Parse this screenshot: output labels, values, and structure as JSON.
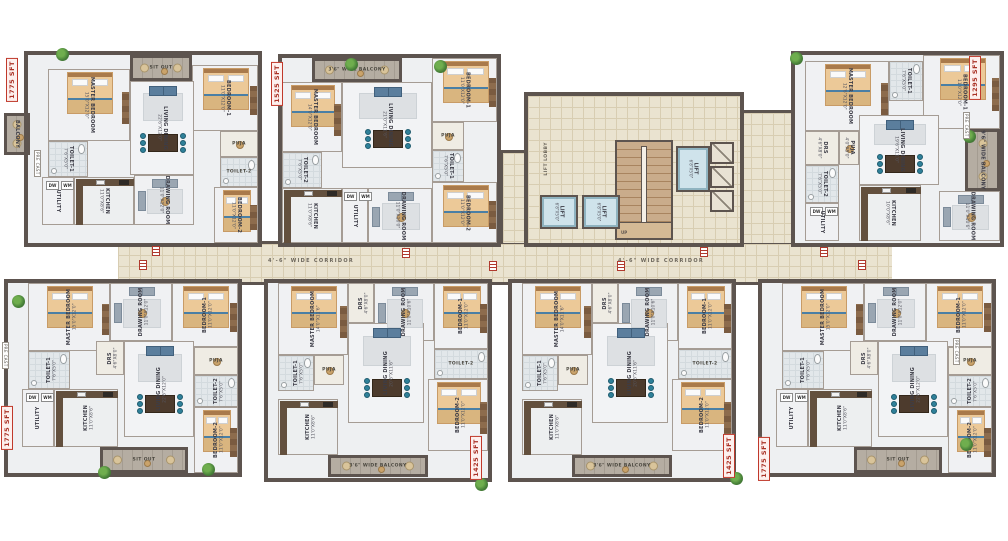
{
  "corridor": {
    "label": "4'-6\" WIDE CORRIDOR"
  },
  "core": {
    "lift_label": "LIFT",
    "lift_dim": "6'8\"X5'0\"",
    "lobby_label": "LIFT LOBBY",
    "stair_label": "UP"
  },
  "labels": {
    "precast": "PRE CAST",
    "appliances": [
      "DW",
      "WM"
    ]
  },
  "units": [
    {
      "id": "unit-t1",
      "size_label": "1775 SFT",
      "x": 28,
      "y": 55,
      "w": 230,
      "h": 188,
      "flip": true,
      "badge": [
        6,
        58
      ],
      "rooms": [
        {
          "name": "MASTER BEDROOM",
          "dim": "15'0\"X12'0\"",
          "type": "bedroom",
          "x": 20,
          "y": 14,
          "w": 82,
          "h": 72
        },
        {
          "name": "SIT OUT",
          "dim": "",
          "type": "balcony",
          "x": 102,
          "y": 0,
          "w": 62,
          "h": 26
        },
        {
          "name": "BEDROOM-1",
          "dim": "11'0\"X12'0\"",
          "type": "bedroom",
          "x": 164,
          "y": 10,
          "w": 66,
          "h": 66
        },
        {
          "name": "BALCONY",
          "dim": "",
          "type": "balcony",
          "x": -24,
          "y": 58,
          "w": 26,
          "h": 42
        },
        {
          "name": "TOILET-1",
          "dim": "7'6\"X5'0\"",
          "type": "toilet",
          "x": 20,
          "y": 86,
          "w": 40,
          "h": 36
        },
        {
          "name": "LIVING DINING",
          "dim": "22'6\"X12'0\"",
          "type": "living",
          "x": 102,
          "y": 26,
          "w": 64,
          "h": 94
        },
        {
          "name": "PUJA",
          "dim": "4'0\"X5'0\"",
          "type": "plain",
          "x": 192,
          "y": 76,
          "w": 38,
          "h": 26
        },
        {
          "name": "TOILET-2",
          "dim": "7'6\"X5'0\"",
          "type": "toilet",
          "x": 192,
          "y": 102,
          "w": 38,
          "h": 30
        },
        {
          "name": "KITCHEN",
          "dim": "11'0\"X8'6\"",
          "type": "kitchen",
          "x": 46,
          "y": 122,
          "w": 60,
          "h": 48
        },
        {
          "name": "UTILITY",
          "dim": "",
          "type": "utility",
          "x": 14,
          "y": 122,
          "w": 32,
          "h": 48
        },
        {
          "name": "DRAWING ROOM",
          "dim": "11'0\"X12'0\"",
          "type": "lounge",
          "x": 106,
          "y": 120,
          "w": 60,
          "h": 50
        },
        {
          "name": "BEDROOM-2",
          "dim": "11'0\"X12'0\"",
          "type": "bedroom",
          "x": 186,
          "y": 132,
          "w": 44,
          "h": 56
        }
      ]
    },
    {
      "id": "unit-t2",
      "size_label": "1525 SFT",
      "x": 282,
      "y": 58,
      "w": 215,
      "h": 185,
      "flip": true,
      "badge": [
        271,
        62
      ],
      "rooms": [
        {
          "name": "3'6\" WIDE BALCONY",
          "dim": "",
          "type": "balcony",
          "x": 30,
          "y": 0,
          "w": 90,
          "h": 24
        },
        {
          "name": "BEDROOM-1",
          "dim": "11'0\"X12'0\"",
          "type": "bedroom",
          "x": 150,
          "y": 0,
          "w": 65,
          "h": 64
        },
        {
          "name": "MASTER BEDROOM",
          "dim": "14'0\"X12'0\"",
          "type": "bedroom",
          "x": 0,
          "y": 24,
          "w": 60,
          "h": 70
        },
        {
          "name": "LIVING DINING",
          "dim": "21'0\"X11'6\"",
          "type": "living",
          "x": 60,
          "y": 24,
          "w": 90,
          "h": 86
        },
        {
          "name": "PUJA",
          "dim": "4'0\"X5'0\"",
          "type": "plain",
          "x": 150,
          "y": 64,
          "w": 32,
          "h": 28
        },
        {
          "name": "TOILET-1",
          "dim": "7'6\"X5'0\"",
          "type": "toilet",
          "x": 150,
          "y": 92,
          "w": 32,
          "h": 32
        },
        {
          "name": "TOILET-2",
          "dim": "7'6\"X5'0\"",
          "type": "toilet",
          "x": 0,
          "y": 94,
          "w": 40,
          "h": 36
        },
        {
          "name": "KITCHEN",
          "dim": "11'0\"X8'6\"",
          "type": "kitchen",
          "x": 0,
          "y": 130,
          "w": 60,
          "h": 55
        },
        {
          "name": "UTILITY",
          "dim": "",
          "type": "utility",
          "x": 60,
          "y": 130,
          "w": 26,
          "h": 55
        },
        {
          "name": "DRAWING ROOM",
          "dim": "11'0\"X10'0\"",
          "type": "lounge",
          "x": 86,
          "y": 130,
          "w": 64,
          "h": 55
        },
        {
          "name": "BEDROOM-2",
          "dim": "11'0\"X12'0\"",
          "type": "bedroom",
          "x": 150,
          "y": 124,
          "w": 65,
          "h": 61
        }
      ]
    },
    {
      "id": "unit-t3",
      "size_label": "1295 SFT",
      "x": 795,
      "y": 55,
      "w": 205,
      "h": 188,
      "flip": true,
      "badge": [
        969,
        56
      ],
      "rooms": [
        {
          "name": "MASTER BEDROOM",
          "dim": "12'6\"X12'0\"",
          "type": "bedroom",
          "x": 10,
          "y": 6,
          "w": 84,
          "h": 70
        },
        {
          "name": "TOILET-1",
          "dim": "7'6\"X5'0\"",
          "type": "toilet",
          "x": 94,
          "y": 6,
          "w": 34,
          "h": 40
        },
        {
          "name": "BEDROOM-1",
          "dim": "11'0\"X12'0\"",
          "type": "bedroom",
          "x": 128,
          "y": 0,
          "w": 77,
          "h": 74
        },
        {
          "name": "DRS",
          "dim": "4'6\"X8'0\"",
          "type": "plain",
          "x": 10,
          "y": 76,
          "w": 34,
          "h": 34
        },
        {
          "name": "PUJA",
          "dim": "4'0\"X5'0\"",
          "type": "plain",
          "x": 44,
          "y": 76,
          "w": 20,
          "h": 34
        },
        {
          "name": "LIVING DINING",
          "dim": "19'6\"X11'0\"",
          "type": "living",
          "x": 64,
          "y": 60,
          "w": 80,
          "h": 70
        },
        {
          "name": "9'6\" WIDE BALCONY",
          "dim": "",
          "type": "balcony",
          "x": 170,
          "y": 74,
          "w": 35,
          "h": 62
        },
        {
          "name": "TOILET-2",
          "dim": "7'6\"X5'0\"",
          "type": "toilet",
          "x": 10,
          "y": 110,
          "w": 34,
          "h": 38
        },
        {
          "name": "UTILITY",
          "dim": "",
          "type": "utility",
          "x": 10,
          "y": 148,
          "w": 34,
          "h": 38
        },
        {
          "name": "KITCHEN",
          "dim": "10'0\"X8'6\"",
          "type": "kitchen",
          "x": 64,
          "y": 130,
          "w": 62,
          "h": 56
        },
        {
          "name": "DRAWING ROOM",
          "dim": "11'0\"X10'6\"",
          "type": "lounge",
          "x": 144,
          "y": 136,
          "w": 61,
          "h": 50
        }
      ]
    },
    {
      "id": "unit-b1",
      "size_label": "1775 SFT",
      "x": 8,
      "y": 283,
      "w": 230,
      "h": 190,
      "flip": false,
      "badge": [
        1,
        406
      ],
      "rooms": [
        {
          "name": "MASTER BEDROOM",
          "dim": "15'0\"X12'0\"",
          "type": "bedroom",
          "x": 20,
          "y": 0,
          "w": 82,
          "h": 68
        },
        {
          "name": "DRAWING ROOM",
          "dim": "11'0\"X12'0\"",
          "type": "lounge",
          "x": 102,
          "y": 0,
          "w": 62,
          "h": 58
        },
        {
          "name": "BEDROOM-1",
          "dim": "11'0\"X12'0\"",
          "type": "bedroom",
          "x": 164,
          "y": 0,
          "w": 66,
          "h": 64
        },
        {
          "name": "TOILET-1",
          "dim": "7'6\"X5'0\"",
          "type": "toilet",
          "x": 20,
          "y": 68,
          "w": 42,
          "h": 38
        },
        {
          "name": "DRS",
          "dim": "4'6\"X8'0\"",
          "type": "plain",
          "x": 88,
          "y": 58,
          "w": 28,
          "h": 34
        },
        {
          "name": "LIVING DINING",
          "dim": "22'6\"X12'0\"",
          "type": "living",
          "x": 116,
          "y": 58,
          "w": 70,
          "h": 96
        },
        {
          "name": "PUJA",
          "dim": "4'0\"X5'0\"",
          "type": "plain",
          "x": 186,
          "y": 64,
          "w": 44,
          "h": 28
        },
        {
          "name": "TOILET-2",
          "dim": "7'6\"X5'0\"",
          "type": "toilet",
          "x": 186,
          "y": 92,
          "w": 44,
          "h": 32
        },
        {
          "name": "KITCHEN",
          "dim": "11'0\"X8'6\"",
          "type": "kitchen",
          "x": 46,
          "y": 106,
          "w": 64,
          "h": 58
        },
        {
          "name": "UTILITY",
          "dim": "",
          "type": "utility",
          "x": 14,
          "y": 106,
          "w": 32,
          "h": 58
        },
        {
          "name": "BEDROOM-2",
          "dim": "11'0\"X12'0\"",
          "type": "bedroom",
          "x": 186,
          "y": 124,
          "w": 44,
          "h": 66
        },
        {
          "name": "SIT OUT",
          "dim": "",
          "type": "balcony",
          "x": 92,
          "y": 164,
          "w": 88,
          "h": 26
        }
      ]
    },
    {
      "id": "unit-b2",
      "size_label": "1425 SFT",
      "x": 268,
      "y": 283,
      "w": 220,
      "h": 195,
      "flip": false,
      "badge": [
        470,
        436
      ],
      "rooms": [
        {
          "name": "MASTER BEDROOM",
          "dim": "14'0\"X11'6\"",
          "type": "bedroom",
          "x": 10,
          "y": 0,
          "w": 70,
          "h": 72
        },
        {
          "name": "DRS",
          "dim": "4'6\"X8'0\"",
          "type": "plain",
          "x": 80,
          "y": 0,
          "w": 26,
          "h": 40
        },
        {
          "name": "DRAWING ROOM",
          "dim": "11'0\"X10'6\"",
          "type": "lounge",
          "x": 106,
          "y": 0,
          "w": 60,
          "h": 58
        },
        {
          "name": "BEDROOM-1",
          "dim": "11'0\"X12'0\"",
          "type": "bedroom",
          "x": 166,
          "y": 0,
          "w": 54,
          "h": 66
        },
        {
          "name": "TOILET-1",
          "dim": "7'6\"X5'0\"",
          "type": "toilet",
          "x": 10,
          "y": 72,
          "w": 36,
          "h": 36
        },
        {
          "name": "PUJA",
          "dim": "4'0\"X5'0\"",
          "type": "plain",
          "x": 46,
          "y": 72,
          "w": 30,
          "h": 30
        },
        {
          "name": "LIVING DINING",
          "dim": "20'6\"X11'6\"",
          "type": "living",
          "x": 80,
          "y": 40,
          "w": 76,
          "h": 100
        },
        {
          "name": "TOILET-2",
          "dim": "7'6\"X5'0\"",
          "type": "toilet",
          "x": 166,
          "y": 66,
          "w": 54,
          "h": 30
        },
        {
          "name": "KITCHEN",
          "dim": "11'0\"X8'6\"",
          "type": "kitchen",
          "x": 10,
          "y": 116,
          "w": 60,
          "h": 56
        },
        {
          "name": "BEDROOM-2",
          "dim": "11'0\"X12'0\"",
          "type": "bedroom",
          "x": 160,
          "y": 96,
          "w": 60,
          "h": 72
        },
        {
          "name": "3'6\" WIDE BALCONY",
          "dim": "",
          "type": "balcony",
          "x": 60,
          "y": 172,
          "w": 100,
          "h": 22
        }
      ]
    },
    {
      "id": "unit-b3",
      "size_label": "1425 SFT",
      "x": 512,
      "y": 283,
      "w": 220,
      "h": 195,
      "flip": false,
      "badge": [
        723,
        434
      ],
      "mirror_of": 4
    },
    {
      "id": "unit-b4",
      "size_label": "1775 SFT",
      "x": 762,
      "y": 283,
      "w": 230,
      "h": 190,
      "flip": false,
      "badge": [
        758,
        437
      ],
      "mirror_of": 3
    }
  ],
  "decor": {
    "markers": [
      [
        152,
        246
      ],
      [
        139,
        260
      ],
      [
        402,
        248
      ],
      [
        489,
        261
      ],
      [
        617,
        261
      ],
      [
        700,
        247
      ],
      [
        820,
        247
      ],
      [
        858,
        260
      ]
    ],
    "plants": [
      [
        56,
        48
      ],
      [
        345,
        58
      ],
      [
        434,
        60
      ],
      [
        790,
        52
      ],
      [
        963,
        130
      ],
      [
        12,
        295
      ],
      [
        98,
        466
      ],
      [
        202,
        463
      ],
      [
        475,
        478
      ],
      [
        730,
        472
      ],
      [
        960,
        438
      ]
    ],
    "precast_tags": [
      [
        34,
        150
      ],
      [
        2,
        342
      ],
      [
        963,
        112
      ],
      [
        953,
        338
      ]
    ]
  }
}
